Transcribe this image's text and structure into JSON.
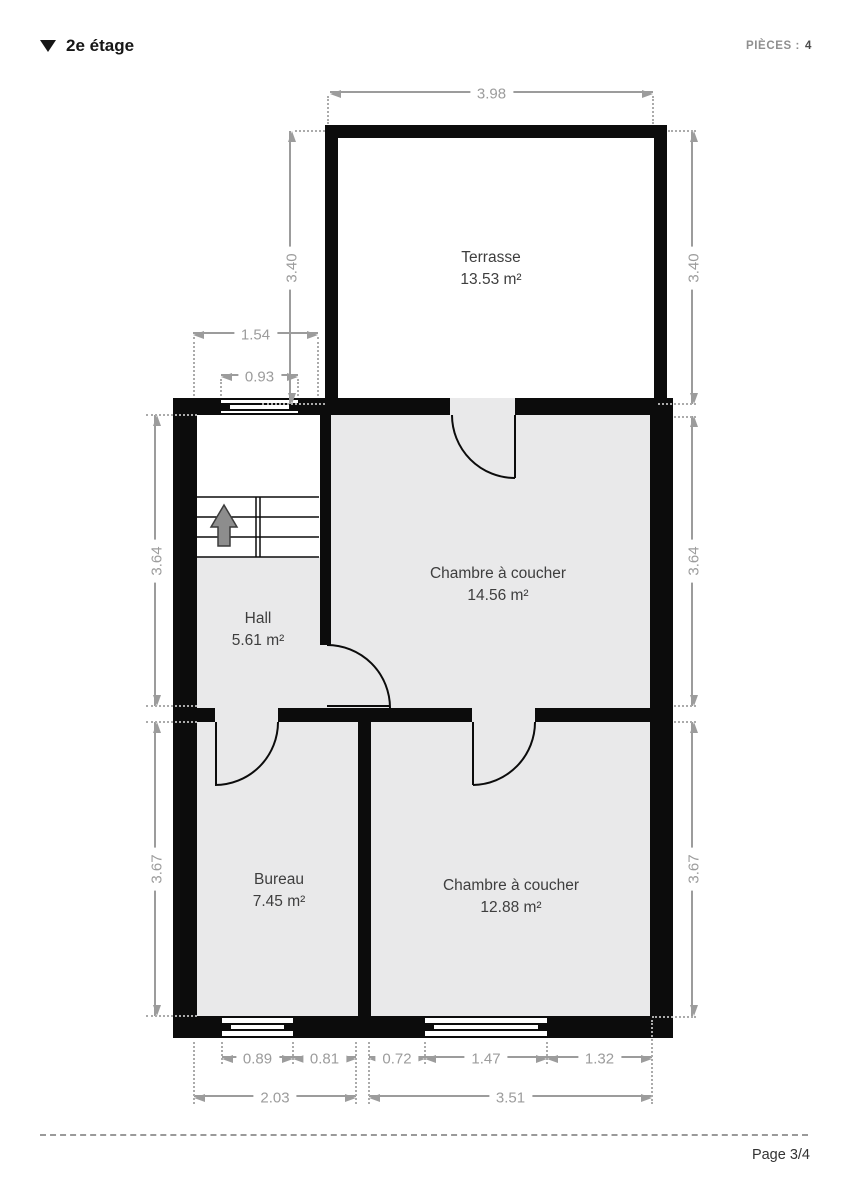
{
  "header": {
    "floor_label": "2e étage",
    "rooms_count_label": "PIÈCES :",
    "rooms_count_value": "4"
  },
  "rooms": [
    {
      "name": "Terrasse",
      "area": "13.53 m²"
    },
    {
      "name": "Chambre à coucher",
      "area": "14.56 m²"
    },
    {
      "name": "Hall",
      "area": "5.61 m²"
    },
    {
      "name": "Bureau",
      "area": "7.45 m²"
    },
    {
      "name": "Chambre à coucher",
      "area": "12.88 m²"
    }
  ],
  "dimensions": {
    "terrace_width": "3.98",
    "terrace_height_left": "3.40",
    "terrace_height_right": "3.40",
    "hall_north_width": "1.54",
    "hall_window_width": "0.93",
    "upper_depth_left": "3.64",
    "upper_depth_right": "3.64",
    "lower_depth_left": "3.67",
    "lower_depth_right": "3.67",
    "bureau_window_width": "0.89",
    "bureau_window_offset": "0.81",
    "bedroom_window_offset": "0.72",
    "bedroom_window_width": "1.47",
    "bedroom_window_right": "1.32",
    "bureau_total_width": "2.03",
    "bedroom_total_width": "3.51"
  },
  "footer": {
    "page_label": "Page 3/4"
  },
  "colors": {
    "wall": "#0c0c0c",
    "room_fill": "#e9e9ea",
    "dimension": "#9c9c9c",
    "label": "#3e3e3e"
  }
}
